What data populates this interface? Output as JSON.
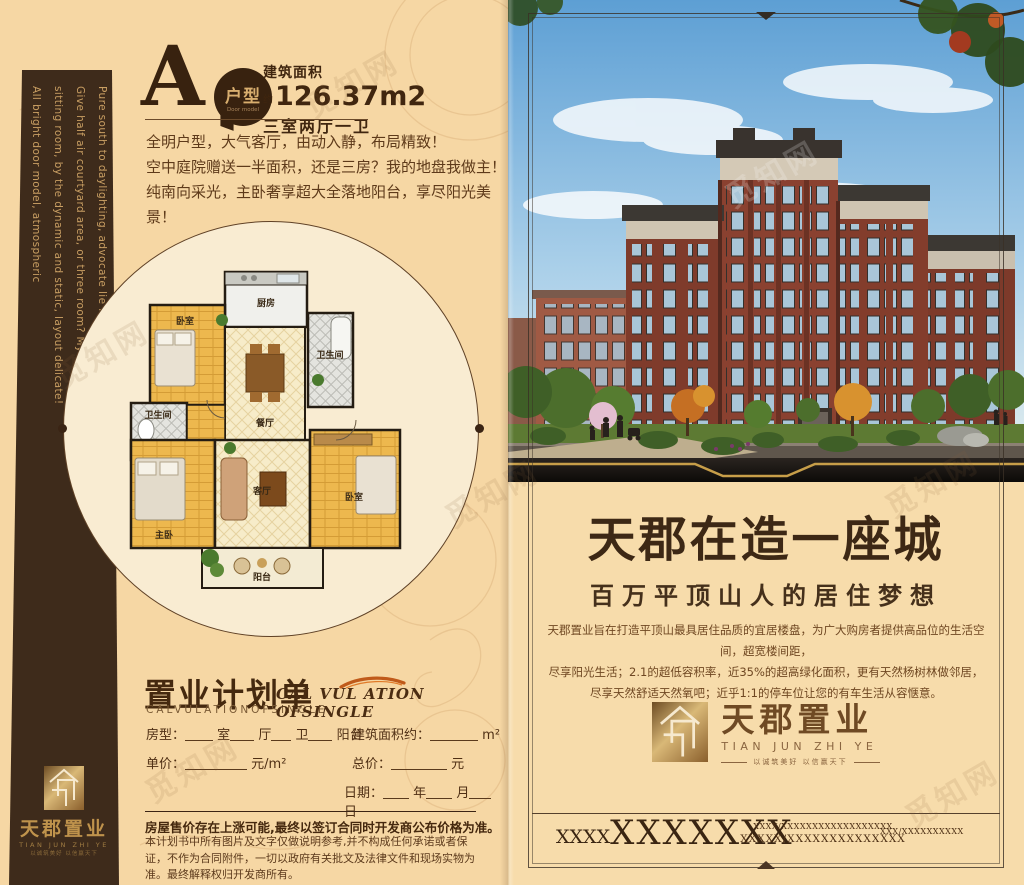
{
  "colors": {
    "page_bg": "#f6d7a4",
    "sidebar_brown": "#3e2b1b",
    "accent_gold": "#c9a24a",
    "text_brown": "#45290f"
  },
  "watermark": "觅知网",
  "left": {
    "sidebar": {
      "lines": [
        "All bright door model, atmospheric",
        "sitting room, by the dynamic and static, layout delicate!",
        "Give half air courtyard area, or three room? My site I make decision!",
        "Pure south to daylighting, advocate lie large luxury to enjoy the whole floor"
      ],
      "logo_name": "天郡置业",
      "logo_en": "TIAN JUN ZHI YE",
      "logo_tagline": "以诚筑美好  以信赢天下"
    },
    "unit": {
      "letter": "A",
      "bubble": "户型",
      "bubble_en": "Door model",
      "area_label": "建筑面积",
      "approx": "约",
      "area": "126.37m2",
      "rooms": "三室两厅一卫",
      "desc1": "全明户型，大气客厅，由动入静，布局精致！",
      "desc2": "空中庭院赠送一半面积，还是三房？我的地盘我做主！",
      "desc3": "纯南向采光，主卧奢享超大全落地阳台，享尽阳光美景！"
    },
    "floorplan": {
      "kitchen": "厨房",
      "bedroom_top": "卧室",
      "bath_right": "卫生间",
      "dining": "餐厅",
      "bath_left": "卫生间",
      "master": "主卧",
      "living": "客厅",
      "bedroom_right": "卧室",
      "balcony": "阳台"
    },
    "form": {
      "title": "置业计划单",
      "subtitle": "CALVULATIONOFSINGLE",
      "subtitle2": "CAL VUL ATION OFSINGLE",
      "housetype": "房型：",
      "u_room": "室",
      "u_hall": "厅",
      "u_bath": "卫",
      "u_balcony": "阳台",
      "area_label": "建筑面积约：",
      "area_unit": "m²",
      "price_label": "单价：",
      "price_unit": "元/m²",
      "total_label": "总价：",
      "total_unit": "元",
      "date_label": "日期：",
      "u_year": "年",
      "u_month": "月",
      "u_day": "日"
    },
    "disclaimer": {
      "bold": "房屋售价存在上涨可能,最终以签订合同时开发商公布价格为准。",
      "text": "本计划书中所有图片及文字仅做说明参考,并不构成任何承诺或者保证，不作为合同附件，一切以政府有关批文及法律文件和现场实物为准。最终解释权归开发商所有。"
    }
  },
  "right": {
    "headline": "天郡在造一座城",
    "subheadline": "百万平顶山人的居住梦想",
    "para1": "天郡置业旨在打造平顶山最具居住品质的宜居楼盘，为广大购房者提供高品位的生活空间，超宽楼间距，",
    "para2": "尽享阳光生活；2.1的超低容积率，近35%的超高绿化面积，更有天然杨树林做邻居，",
    "para3": "尽享天然舒适天然氧吧；近乎1:1的停车位让您的有车生活从容惬意。",
    "logo_name": "天郡置业",
    "logo_en": "TIAN JUN ZHI YE",
    "logo_tagline": "以诚筑美好  以信赢天下",
    "contact": {
      "big_prefix": "XXXX",
      "big": "XXXXXXX",
      "mid1": "XXXX/XXXXXXXXXXXXXXXXXX",
      "mid2": "XXXXX/XXXXXXXXXXXXXX",
      "right1": "XXX/XXXXXXXXXX"
    }
  }
}
